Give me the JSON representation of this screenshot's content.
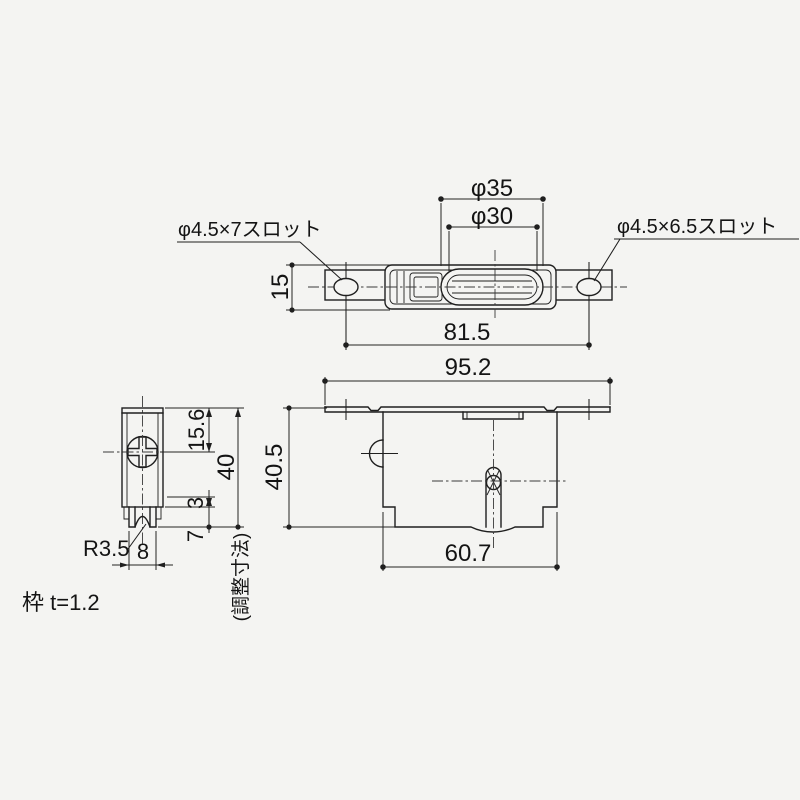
{
  "drawing": {
    "title_note": "枠 t=1.2",
    "top_view": {
      "dim_wheel_outer": "φ35",
      "dim_wheel_groove": "φ30",
      "label_left_slot": "φ4.5×7スロット",
      "label_right_slot": "φ4.5×6.5スロット",
      "dim_plate_height": "15",
      "dim_slot_span": "81.5"
    },
    "front_view": {
      "dim_overall_width": "95.2",
      "dim_overall_height": "40.5",
      "dim_body_width": "60.7"
    },
    "side_view": {
      "dim_screw_offset": "15.6",
      "dim_frame_height": "40",
      "dim_adjust_range": "3",
      "dim_wheel_protrusion": "7",
      "dim_frame_width": "8",
      "label_groove_radius": "R3.5",
      "label_adjust": "(調整寸法)"
    },
    "colors": {
      "line": "#1f1f1f",
      "paper": "#f4f4f2"
    }
  }
}
